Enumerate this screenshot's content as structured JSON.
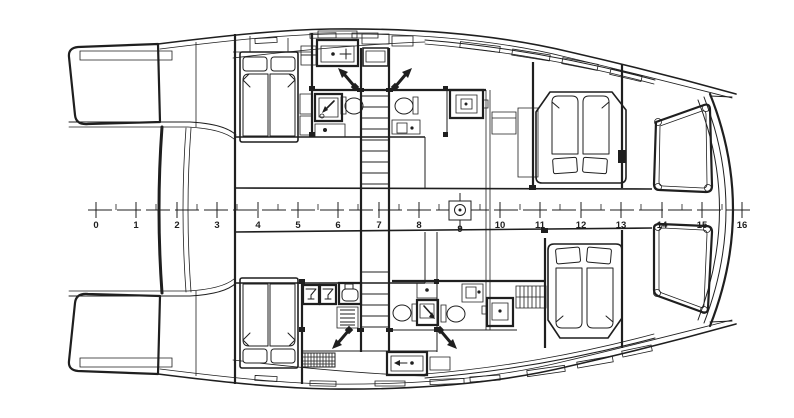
{
  "drawing": {
    "kind": "catamaran-yacht-deck-plan",
    "background": "#ffffff",
    "line_color": "#1f1f1f"
  },
  "ruler": {
    "unit_labels": [
      "0",
      "1",
      "2",
      "3",
      "4",
      "5",
      "6",
      "7",
      "8",
      "9",
      "10",
      "11",
      "12",
      "13",
      "14",
      "15",
      "16"
    ],
    "units_shown": 17,
    "mast_at_unit": "9"
  },
  "icons": {
    "double_berth": "bed-with-two-mattresses-and-pillows",
    "stairs": "companionway-ladder",
    "toilet": "wc-bowl-oval",
    "shower": "nested-squares-stall",
    "washbasin": "rect-with-tap-dot",
    "wine_glass": "glass-in-square",
    "mast_marker": "square-with-circle-on-centerline",
    "hatch_arrow": "diagonal-arrow-with-diamond-tail",
    "hanging_locker": "comb-hatch",
    "floor_grate": "cross-hatched-rectangle"
  }
}
